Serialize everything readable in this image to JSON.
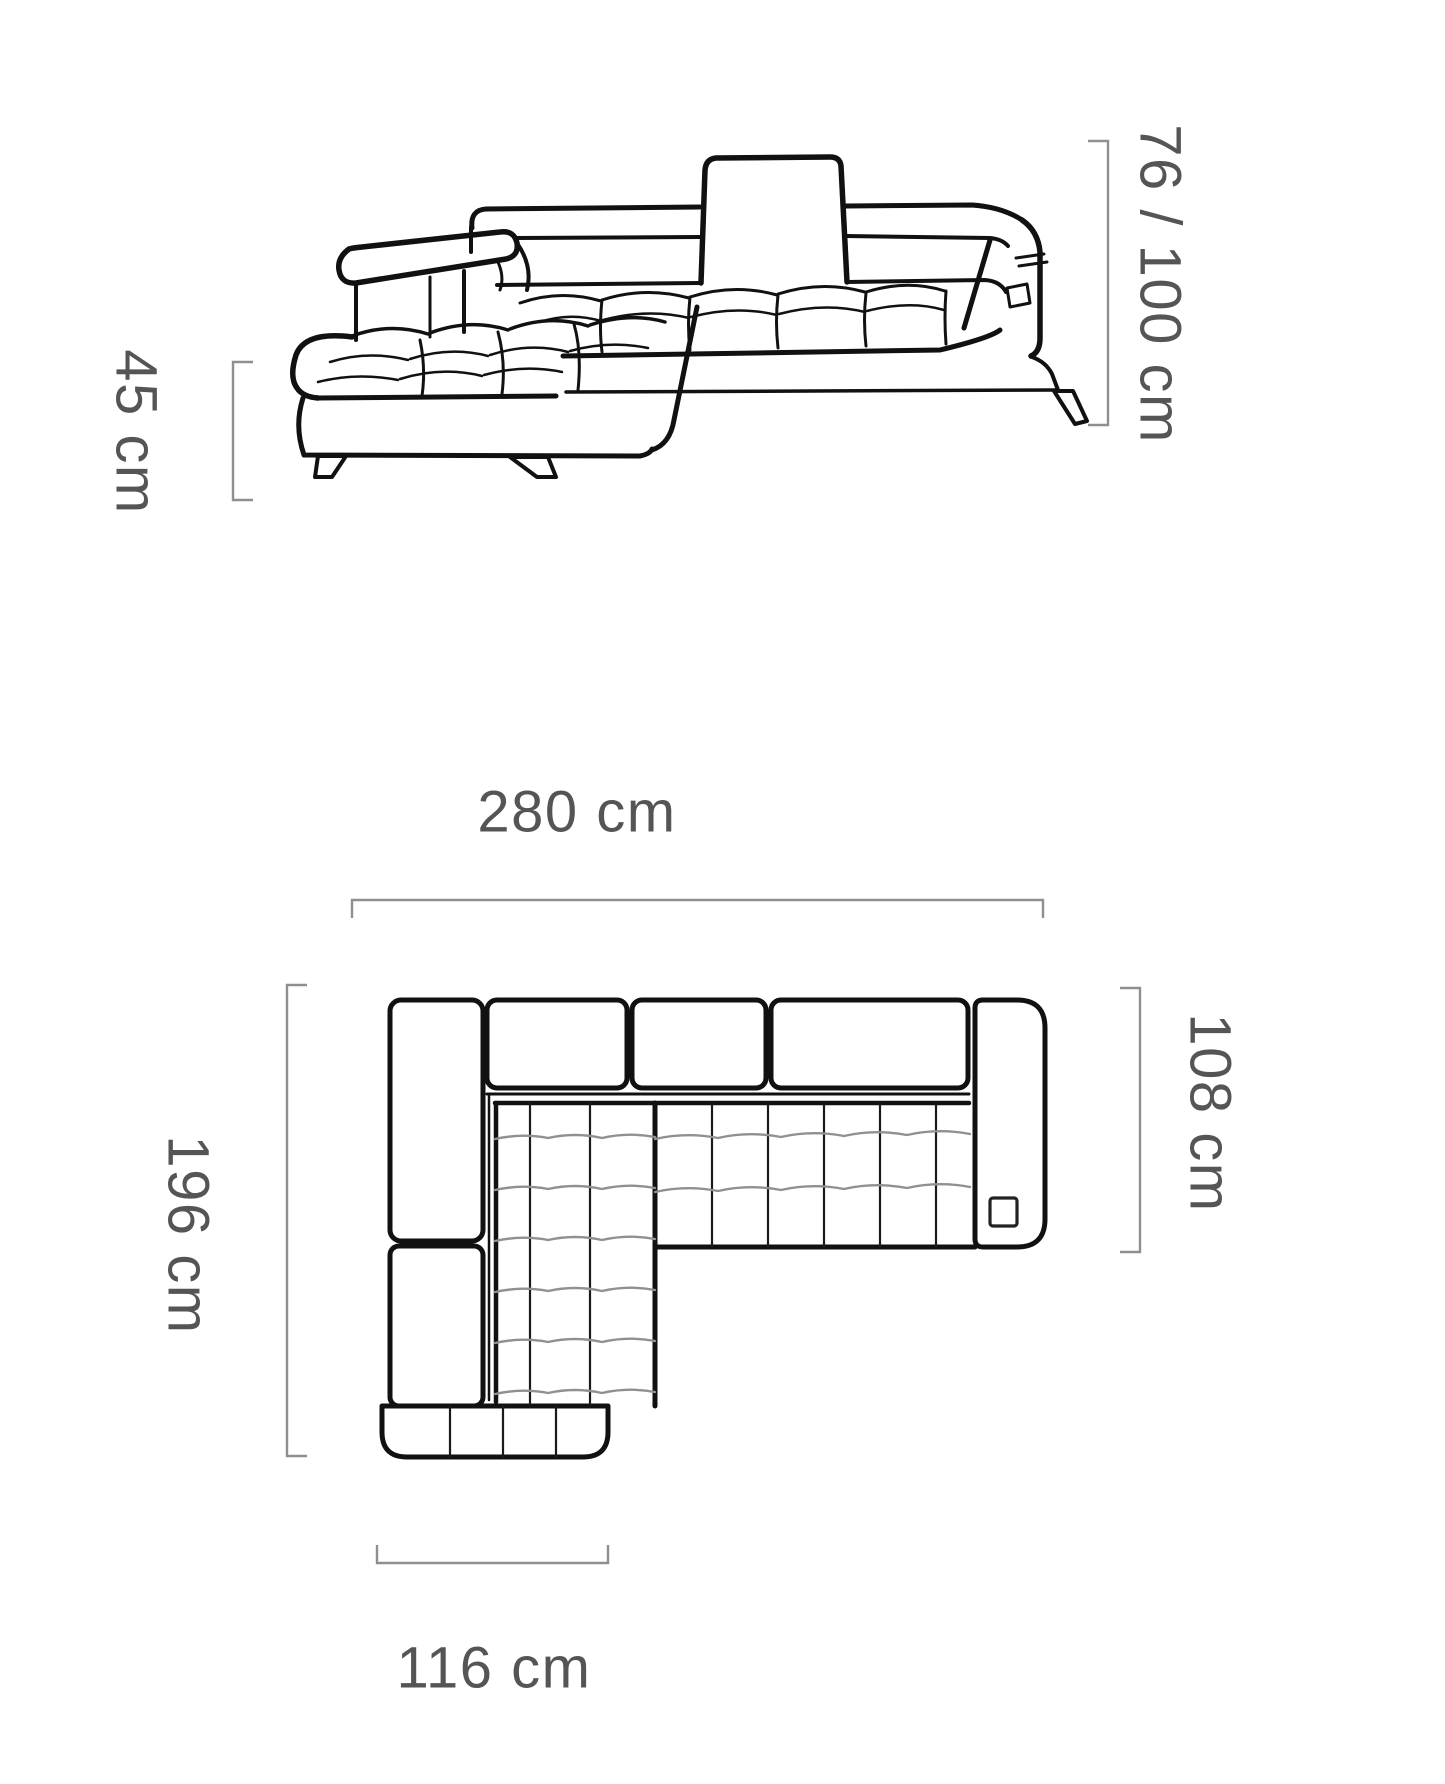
{
  "title": "Corner sofa dimensions diagram",
  "views": {
    "front_view": {
      "name": "front-perspective-view",
      "dim_seat_height": "45 cm",
      "dim_back_height": "76 / 100 cm"
    },
    "plan_view": {
      "name": "top-plan-view",
      "dim_total_width": "280 cm",
      "dim_side_length": "196 cm",
      "dim_body_depth": "108 cm",
      "dim_chaise_width": "116 cm"
    }
  },
  "colors": {
    "background": "#ffffff",
    "outline": "#111111",
    "quilt_line": "#909090",
    "dimension_line": "#8f8f8f",
    "dimension_text": "#555555"
  }
}
